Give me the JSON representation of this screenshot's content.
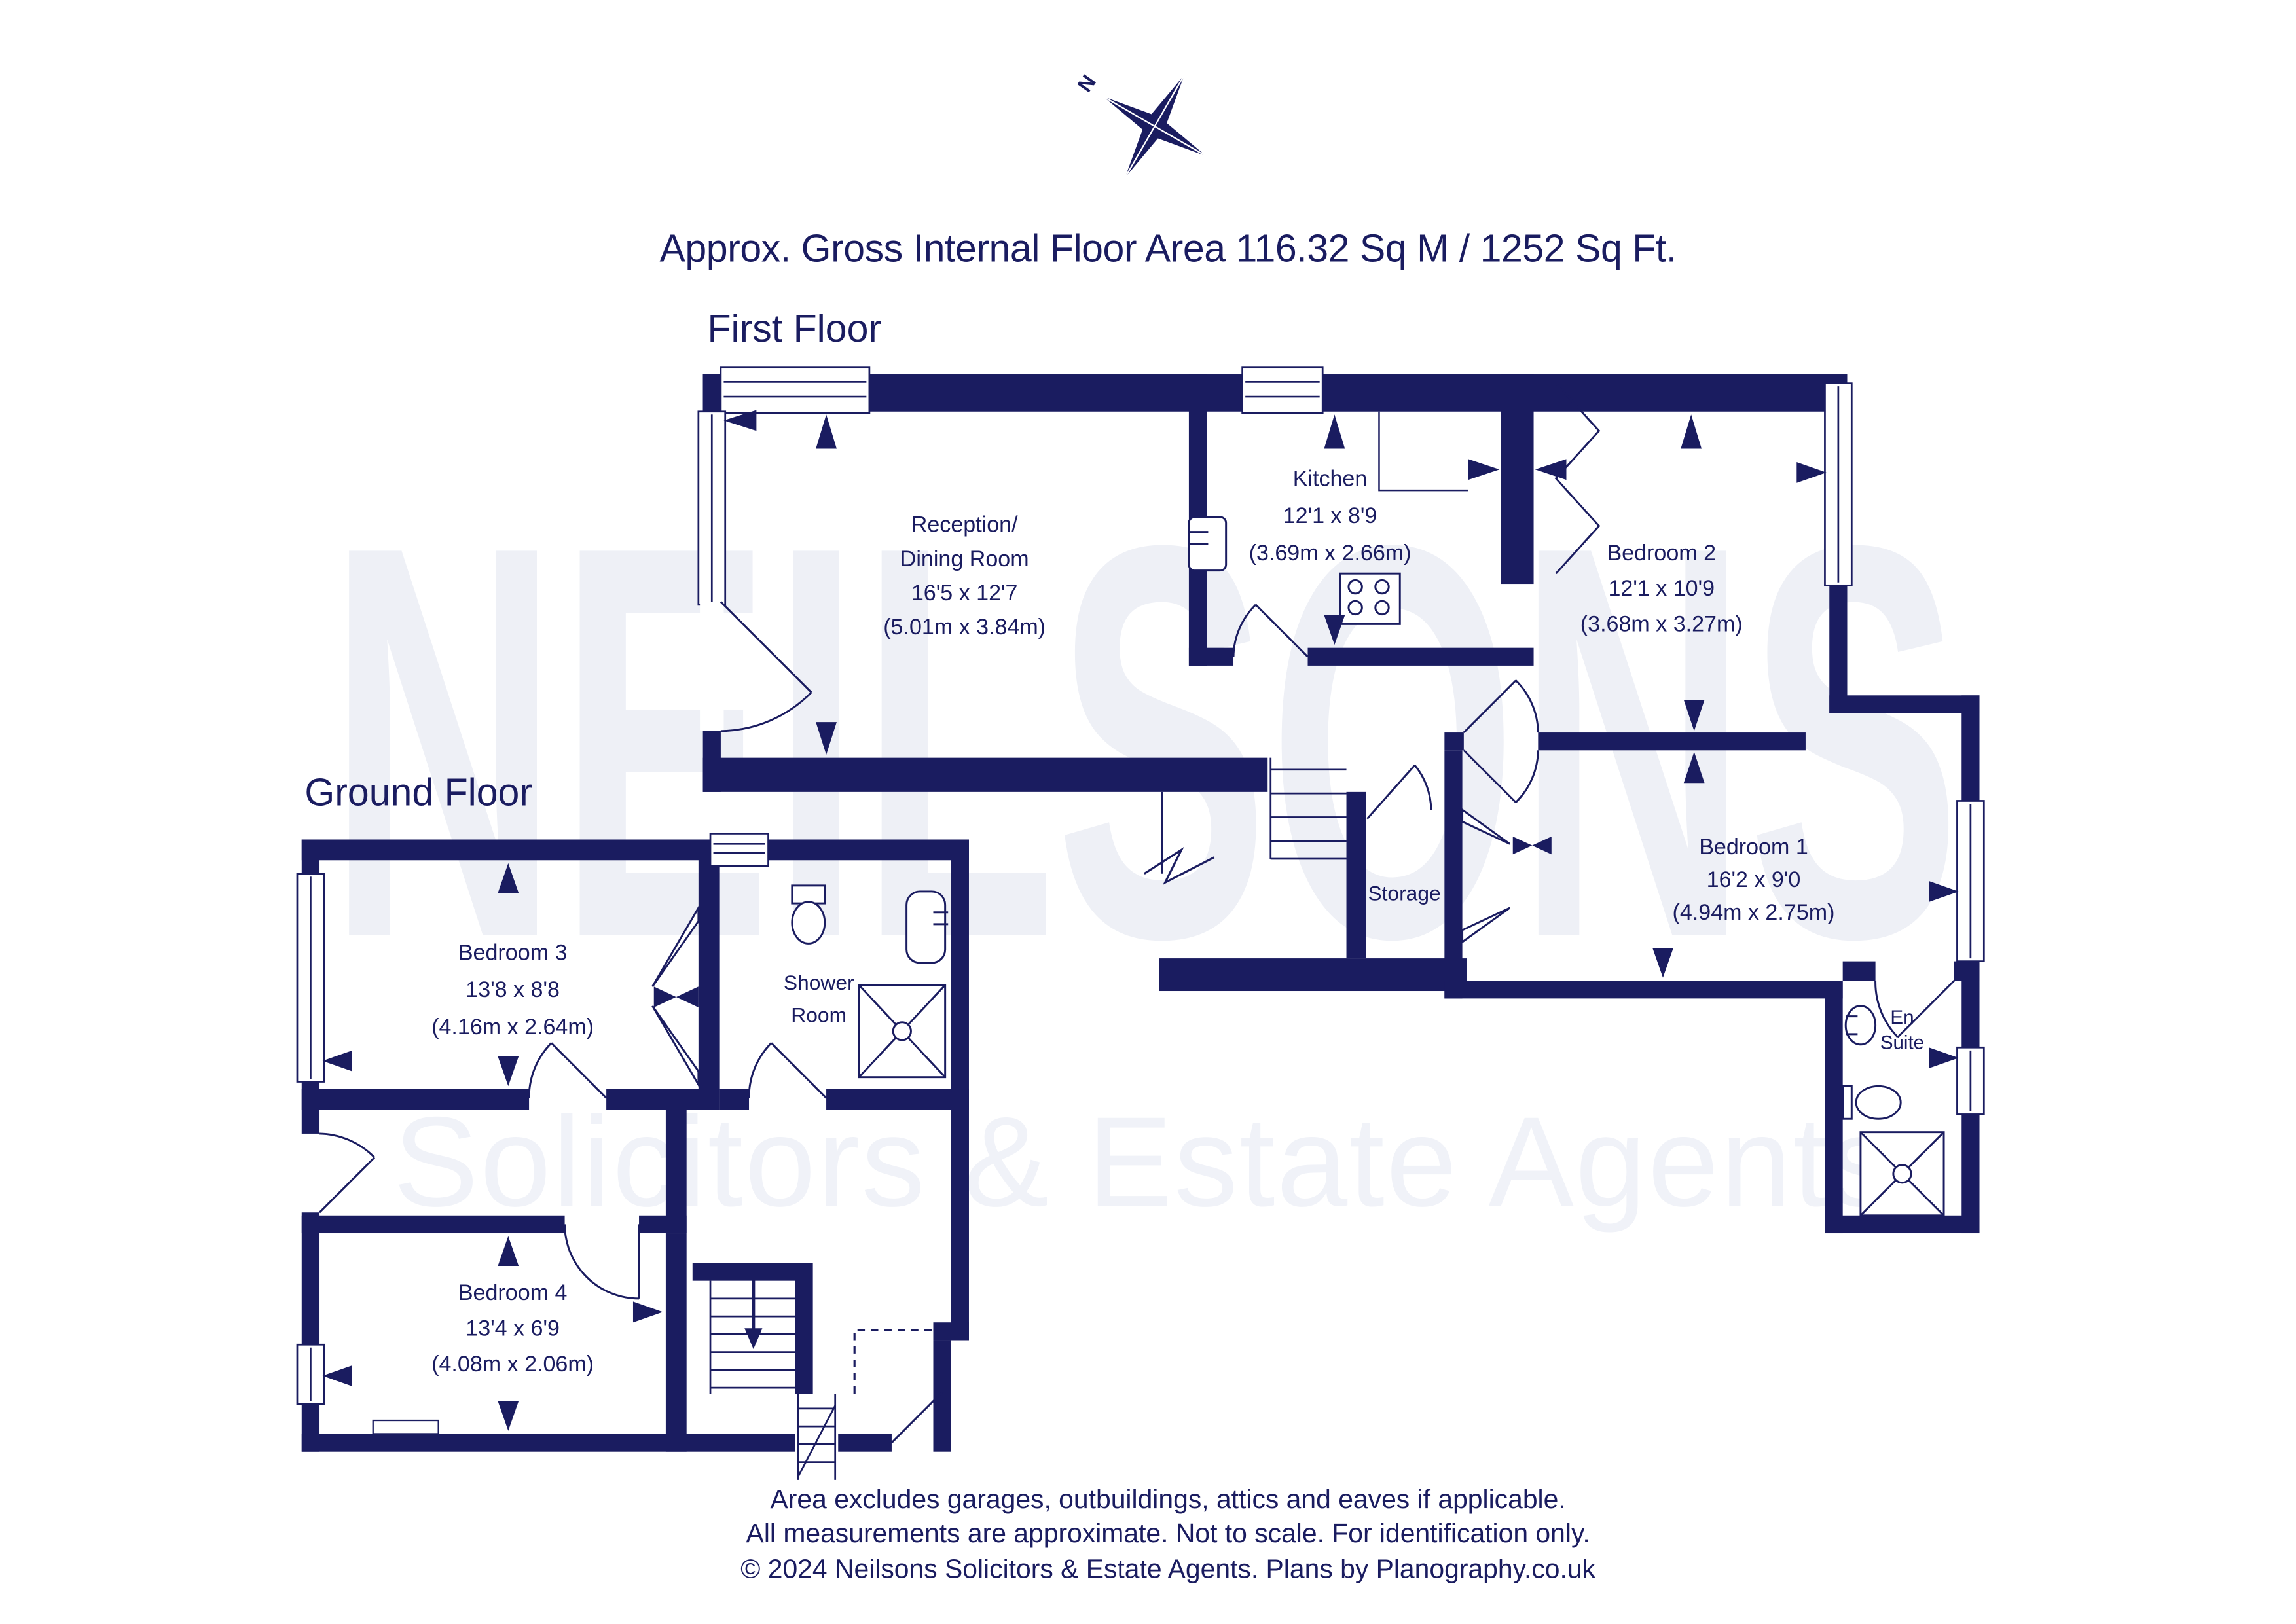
{
  "title": "Approx. Gross Internal Floor Area 116.32 Sq M / 1252 Sq Ft.",
  "compass": {
    "north_label": "N",
    "icon": "compass-star-icon"
  },
  "colors": {
    "navy": "#1a1c60",
    "watermark_big": "#eef0f6",
    "watermark_small": "#f0f2f8"
  },
  "watermark": {
    "line1": "NEILSONS",
    "line2": "Solicitors & Estate Agents"
  },
  "first_floor": {
    "label": "First Floor",
    "rooms": {
      "reception": {
        "name_line1": "Reception/",
        "name_line2": "Dining Room",
        "size_imperial": "16'5 x 12'7",
        "size_metric": "(5.01m x 3.84m)"
      },
      "kitchen": {
        "name": "Kitchen",
        "size_imperial": "12'1 x 8'9",
        "size_metric": "(3.69m x 2.66m)"
      },
      "bedroom2": {
        "name": "Bedroom 2",
        "size_imperial": "12'1 x 10'9",
        "size_metric": "(3.68m x 3.27m)"
      },
      "bedroom1": {
        "name": "Bedroom 1",
        "size_imperial": "16'2 x 9'0",
        "size_metric": "(4.94m x 2.75m)"
      },
      "storage": {
        "name": "Storage"
      },
      "en_suite": {
        "name_line1": "En",
        "name_line2": "Suite"
      }
    }
  },
  "ground_floor": {
    "label": "Ground Floor",
    "rooms": {
      "bedroom3": {
        "name": "Bedroom 3",
        "size_imperial": "13'8 x 8'8",
        "size_metric": "(4.16m x 2.64m)"
      },
      "shower_room": {
        "name_line1": "Shower",
        "name_line2": "Room"
      },
      "bedroom4": {
        "name": "Bedroom 4",
        "size_imperial": "13'4 x 6'9",
        "size_metric": "(4.08m x 2.06m)"
      }
    }
  },
  "footer": {
    "line1": "Area excludes garages, outbuildings, attics and eaves if applicable.",
    "line2": "All measurements are approximate. Not to scale. For identification only.",
    "line3": "© 2024 Neilsons Solicitors & Estate Agents. Plans by Planography.co.uk"
  }
}
